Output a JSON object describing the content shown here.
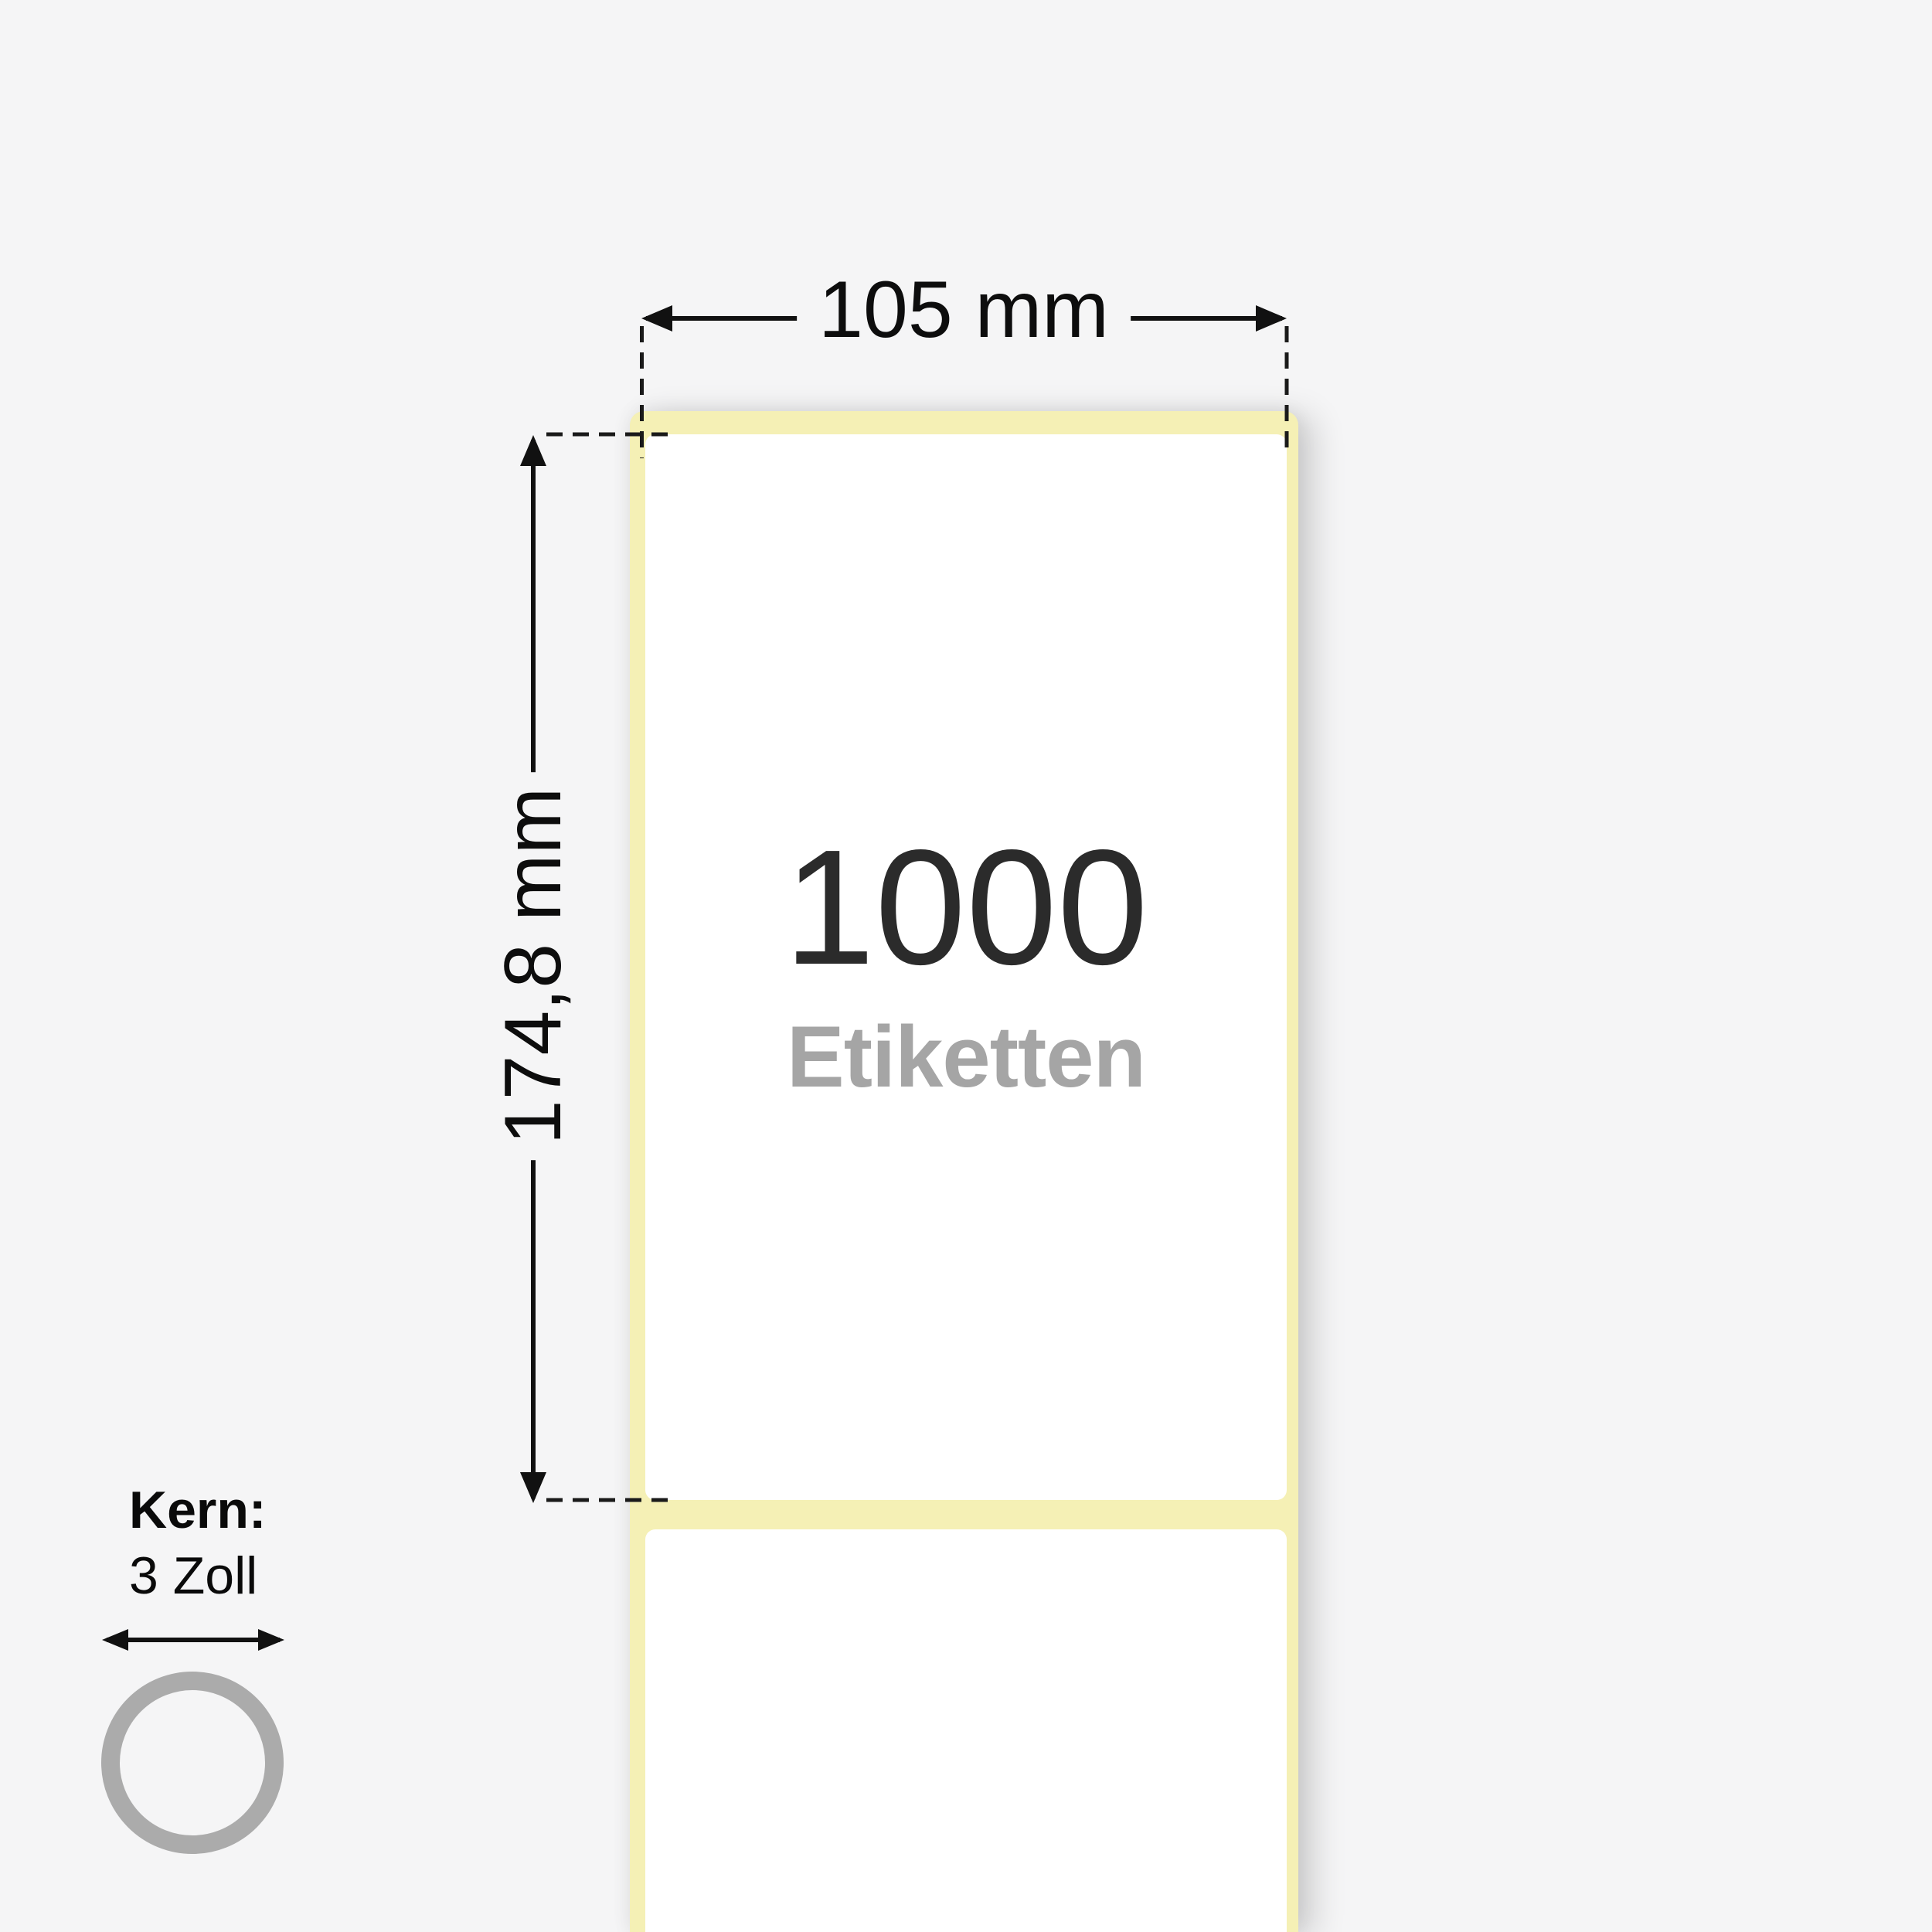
{
  "diagram": {
    "background_color": "#f5f5f6",
    "roll": {
      "liner_color": "#f5f0b5",
      "label_color": "#ffffff",
      "count": "1000",
      "count_unit": "Etiketten",
      "count_color": "#2b2b2b",
      "count_unit_color": "#a5a5a5"
    },
    "width_dimension": {
      "label": "105 mm",
      "line_color": "#111111"
    },
    "height_dimension": {
      "label": "174,8 mm",
      "line_color": "#111111"
    },
    "core": {
      "title": "Kern:",
      "size": "3 Zoll",
      "ring_color": "#ababab"
    }
  }
}
